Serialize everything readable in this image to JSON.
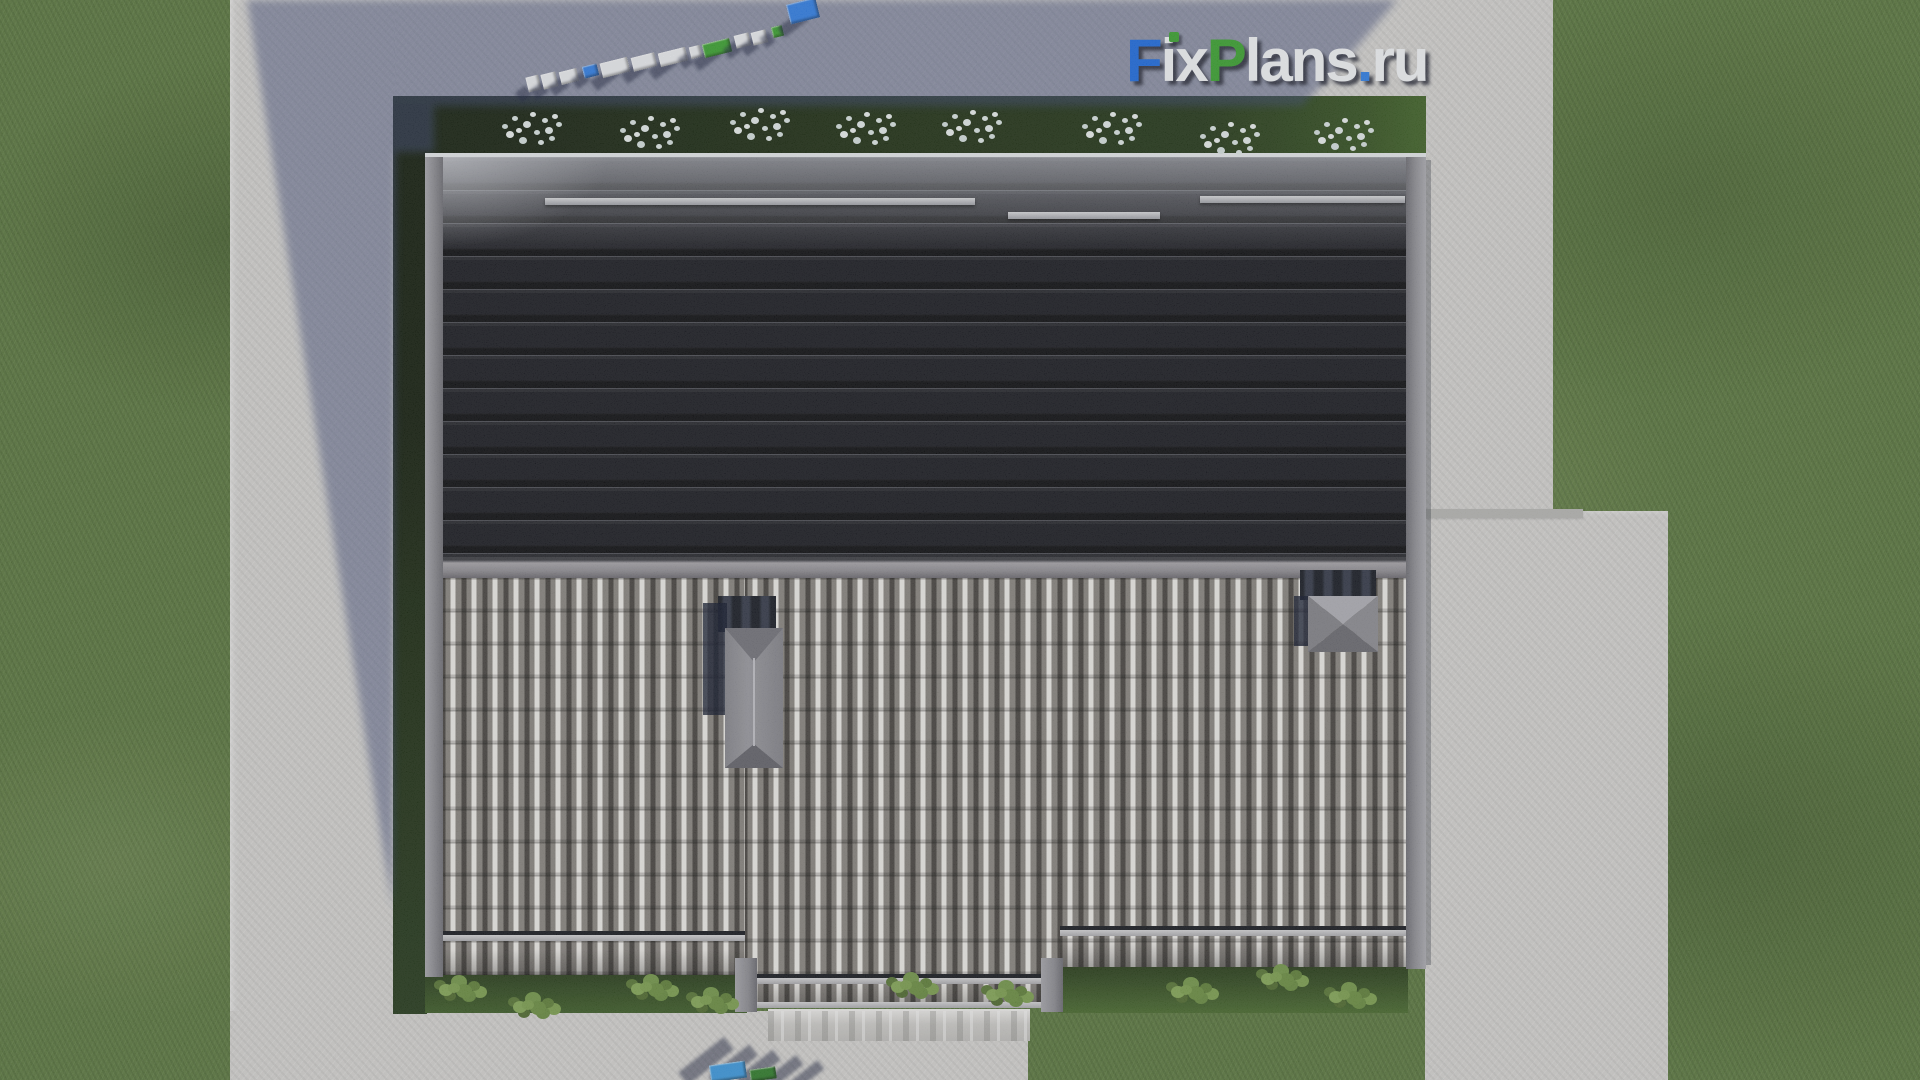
{
  "watermark": {
    "text": "FixPlans.ru",
    "segments": [
      {
        "text": "F",
        "color": "#1c6ce2"
      },
      {
        "text": "ix",
        "color": "#f5f7fb"
      },
      {
        "text": "P",
        "color": "#3aa42f"
      },
      {
        "text": "lans",
        "color": "#f5f7fb"
      },
      {
        "text": ".",
        "color": "#2e7fe8"
      },
      {
        "text": "ru",
        "color": "#f5f7fb"
      }
    ],
    "i_dot_color": "#3aa42f"
  },
  "colors": {
    "lawn": "#5b793e",
    "hedge": "#22361a",
    "concrete": "#d6d5d3",
    "concrete_shadow": "#8288a2",
    "roof_dark_tiles": "#4b4d57",
    "roof_light_tiles": "#8e8a85",
    "ridge": "#98969b",
    "chimney": "#94949a",
    "sign_blue": "#2f7fe8",
    "sign_green": "#3aa42f",
    "sign_white": "#eef0f4"
  },
  "garden": {
    "flower_clusters": [
      {
        "x": 516,
        "y": 128
      },
      {
        "x": 634,
        "y": 132
      },
      {
        "x": 744,
        "y": 124
      },
      {
        "x": 850,
        "y": 128
      },
      {
        "x": 956,
        "y": 126
      },
      {
        "x": 1096,
        "y": 128
      },
      {
        "x": 1214,
        "y": 138
      },
      {
        "x": 1328,
        "y": 134
      }
    ],
    "bushes": [
      {
        "x": 448,
        "y": 983
      },
      {
        "x": 522,
        "y": 1000
      },
      {
        "x": 640,
        "y": 982
      },
      {
        "x": 700,
        "y": 995
      },
      {
        "x": 900,
        "y": 980
      },
      {
        "x": 995,
        "y": 988
      },
      {
        "x": 1180,
        "y": 985
      },
      {
        "x": 1270,
        "y": 972
      },
      {
        "x": 1338,
        "y": 990
      }
    ]
  },
  "top_sign": {
    "angle_deg": -14,
    "blocks": [
      {
        "x": 527,
        "y": 76,
        "w": 13,
        "h": 15,
        "color": "#eef0f4"
      },
      {
        "x": 542,
        "y": 73,
        "w": 15,
        "h": 15,
        "color": "#eef0f4"
      },
      {
        "x": 560,
        "y": 70,
        "w": 18,
        "h": 13,
        "color": "#eef0f4"
      },
      {
        "x": 583,
        "y": 65,
        "w": 15,
        "h": 12,
        "color": "#2f7fe8"
      },
      {
        "x": 601,
        "y": 60,
        "w": 28,
        "h": 15,
        "color": "#eef0f4"
      },
      {
        "x": 632,
        "y": 55,
        "w": 24,
        "h": 14,
        "color": "#eef0f4"
      },
      {
        "x": 659,
        "y": 50,
        "w": 28,
        "h": 14,
        "color": "#eef0f4"
      },
      {
        "x": 690,
        "y": 46,
        "w": 11,
        "h": 12,
        "color": "#eef0f4"
      },
      {
        "x": 703,
        "y": 41,
        "w": 28,
        "h": 14,
        "color": "#3aa42f"
      },
      {
        "x": 735,
        "y": 34,
        "w": 15,
        "h": 13,
        "color": "#eef0f4"
      },
      {
        "x": 752,
        "y": 31,
        "w": 15,
        "h": 13,
        "color": "#eef0f4"
      },
      {
        "x": 772,
        "y": 26,
        "w": 11,
        "h": 11,
        "color": "#3aa42f"
      },
      {
        "x": 788,
        "y": 1,
        "w": 30,
        "h": 20,
        "color": "#2f7fe8"
      }
    ]
  },
  "bottom_sign": {
    "blocks": [
      {
        "x": 710,
        "y": 1063,
        "w": 36,
        "h": 17,
        "color": "#3b9ae0",
        "rot": -8
      },
      {
        "x": 750,
        "y": 1068,
        "w": 26,
        "h": 12,
        "color": "#2e7d2a",
        "rot": -8
      }
    ],
    "shadows": [
      {
        "x": 698,
        "y": 1032,
        "w": 16,
        "h": 58,
        "rot": 52
      },
      {
        "x": 726,
        "y": 1040,
        "w": 14,
        "h": 52,
        "rot": 52
      },
      {
        "x": 752,
        "y": 1046,
        "w": 13,
        "h": 46,
        "rot": 52
      },
      {
        "x": 778,
        "y": 1052,
        "w": 12,
        "h": 40,
        "rot": 52
      },
      {
        "x": 802,
        "y": 1058,
        "w": 11,
        "h": 34,
        "rot": 52
      }
    ]
  }
}
